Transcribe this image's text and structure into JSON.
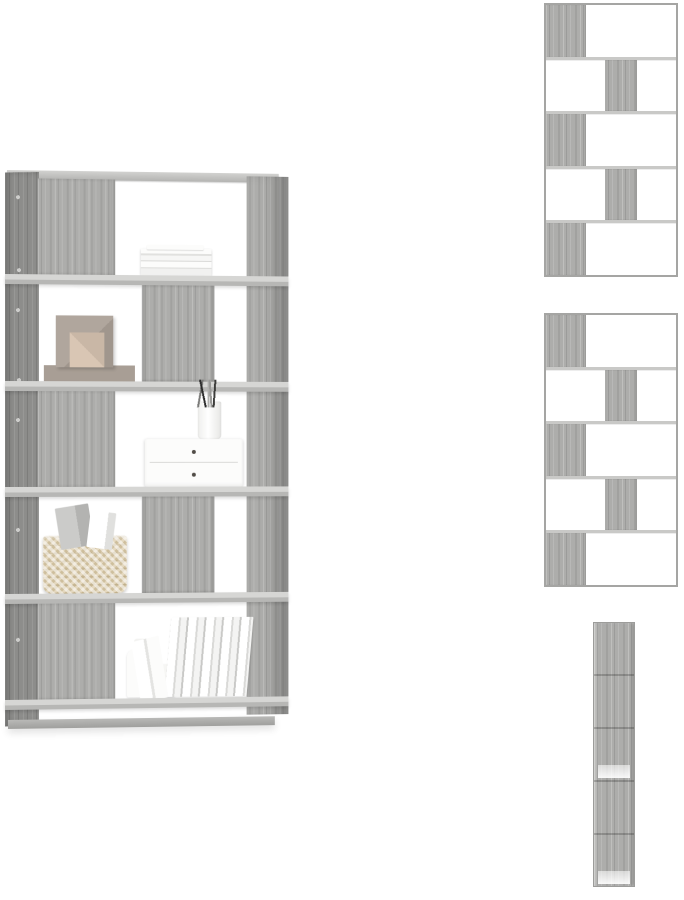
{
  "gallery": {
    "main_view_label": "decorated gray sonoma 5-tier room divider bookcase",
    "thumb_top_label": "front view of empty bookcase",
    "thumb_middle_label": "front view of empty bookcase",
    "thumb_side_label": "side view of bookcase"
  },
  "palette": {
    "background": "#ffffff",
    "wood_base": "#adadab",
    "wood_side": "#8d8d8b",
    "shelf_board": "#c9c9c7",
    "frame": "#a5a5a3",
    "item_white": "#fcfcfb",
    "item_gray": "#d9d9d7",
    "box_taupe": "#b0a69d",
    "box_beige": "#d9c6b4",
    "basket": "#e4d8bf",
    "pen_dark": "#2b2b2b"
  },
  "views": {
    "main": {
      "tiers": [
        {
          "panel": "left",
          "items": [
            "stack-of-flat-books"
          ]
        },
        {
          "panel": "center",
          "items": [
            "decorative-boxes"
          ]
        },
        {
          "panel": "left",
          "items": [
            "drawer-organizer",
            "pencil-cup"
          ]
        },
        {
          "panel": "center",
          "items": [
            "wicker-basket"
          ]
        },
        {
          "panel": "left",
          "items": [
            "white-bottles",
            "upright-books"
          ]
        }
      ]
    },
    "front_thumb_top": {
      "tiers": [
        {
          "panel": "left"
        },
        {
          "panel": "center"
        },
        {
          "panel": "left"
        },
        {
          "panel": "center"
        },
        {
          "panel": "left"
        }
      ]
    },
    "front_thumb_middle": {
      "tiers": [
        {
          "panel": "left"
        },
        {
          "panel": "center"
        },
        {
          "panel": "left"
        },
        {
          "panel": "center"
        },
        {
          "panel": "left"
        }
      ]
    },
    "side_thumb": {
      "sections": 5
    }
  }
}
